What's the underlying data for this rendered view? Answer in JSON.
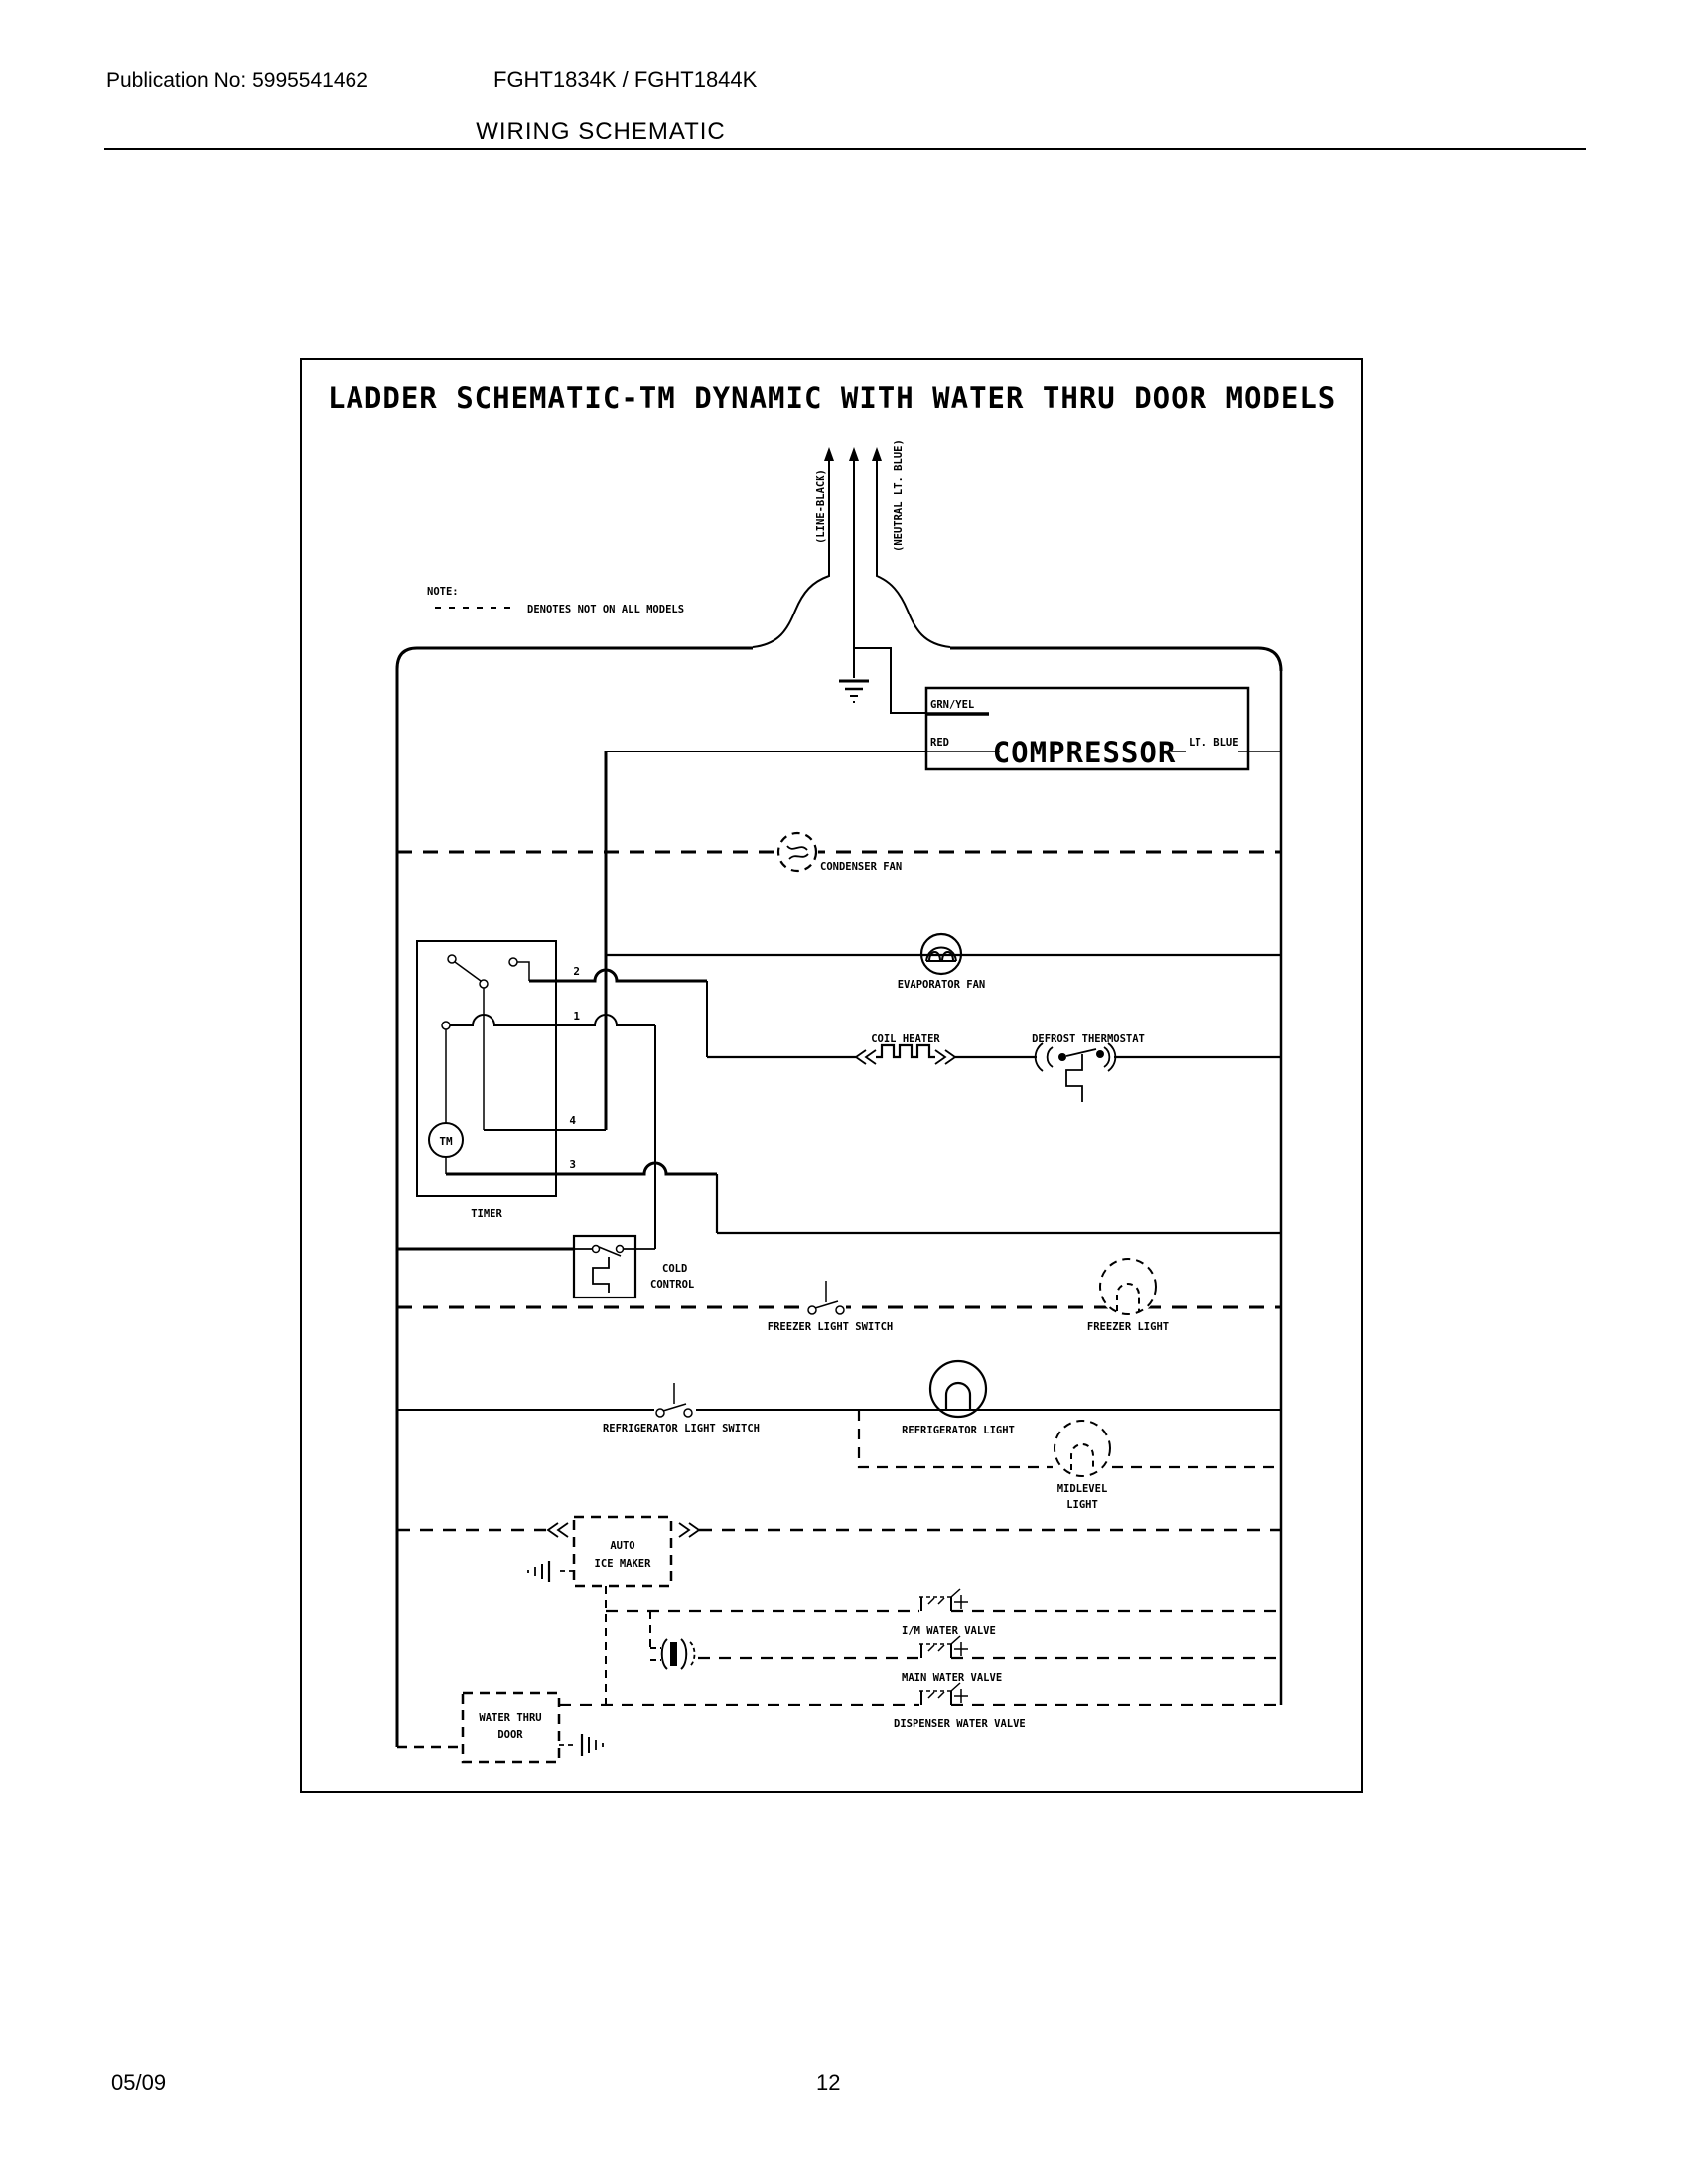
{
  "header": {
    "publication_no": "Publication No: 5995541462",
    "models": "FGHT1834K / FGHT1844K",
    "title": "WIRING SCHEMATIC"
  },
  "footer": {
    "date": "05/09",
    "page_number": "12"
  },
  "schematic": {
    "title": "LADDER SCHEMATIC-TM DYNAMIC WITH WATER THRU DOOR MODELS",
    "note": {
      "label": "NOTE:",
      "text": "DENOTES NOT ON ALL MODELS"
    },
    "power": {
      "line": "(LINE-BLACK)",
      "neutral": "(NEUTRAL LT. BLUE)"
    },
    "compressor": {
      "name": "COMPRESSOR",
      "ground_wire": "GRN/YEL",
      "start_wire": "RED",
      "run_wire": "LT. BLUE"
    },
    "timer": {
      "name": "TIMER",
      "motor": "TM",
      "terminal_1": "1",
      "terminal_2": "2",
      "terminal_3": "3",
      "terminal_4": "4"
    },
    "components": {
      "condenser_fan": "CONDENSER FAN",
      "evaporator_fan": "EVAPORATOR FAN",
      "coil_heater": "COIL HEATER",
      "defrost_thermostat": "DEFROST THERMOSTAT",
      "cold_control": [
        "COLD",
        "CONTROL"
      ],
      "freezer_light_switch": "FREEZER LIGHT SWITCH",
      "freezer_light": "FREEZER LIGHT",
      "refrigerator_light_switch": "REFRIGERATOR LIGHT SWITCH",
      "refrigerator_light": "REFRIGERATOR LIGHT",
      "midlevel_light": [
        "MIDLEVEL",
        "LIGHT"
      ],
      "auto_ice_maker": [
        "AUTO",
        "ICE MAKER"
      ],
      "im_water_valve": "I/M WATER VALVE",
      "main_water_valve": "MAIN WATER VALVE",
      "dispenser_water_valve": "DISPENSER WATER VALVE",
      "water_thru_door": [
        "WATER THRU",
        "DOOR"
      ]
    },
    "ink_color": "#000000",
    "paper_color": "#ffffff"
  }
}
